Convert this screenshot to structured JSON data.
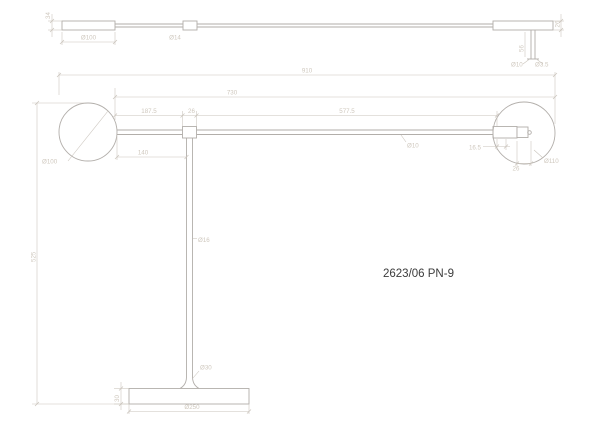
{
  "model_label": "2623/06 PN-9",
  "colors": {
    "line": "#b2aeaa",
    "dim": "#c9c3bb",
    "dimtext": "#cfc8be",
    "model": "#3c3c3c",
    "bg": "#ffffff"
  },
  "top_view": {
    "head_thickness": "34",
    "head_length": "Ø100",
    "arm_diameter": "Ø14",
    "end_cap_thickness": "26",
    "rod_length": "56",
    "rod_diameter": "Ø10",
    "tip_hole_diameter": "Ø3.5"
  },
  "front_view": {
    "overall_width": "910",
    "arm_reach": "730",
    "arm_front_segment": "577.5",
    "head_to_joint": "187.5",
    "joint_width": "26",
    "head_clearance": "140",
    "shade_diameter": "Ø100",
    "arm_tube_diameter": "Ø10",
    "hub_inset": "16.5",
    "hub_pin_width": "26",
    "hub_diameter": "Ø110",
    "pole_diameter": "Ø16",
    "overall_height": "525",
    "stem_foot_diameter": "Ø30",
    "base_thickness": "30",
    "base_diameter": "Ø250"
  }
}
